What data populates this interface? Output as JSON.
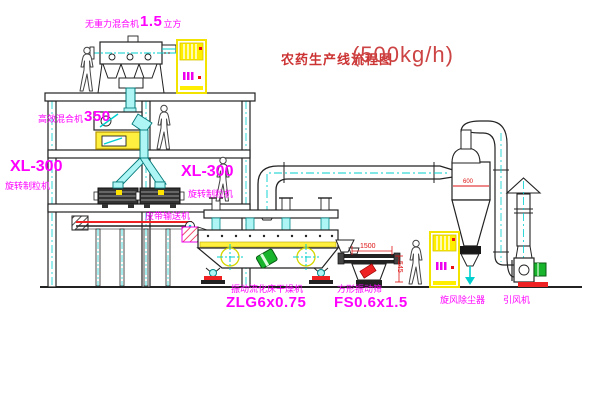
{
  "title": {
    "name": "农药生产线流程图",
    "capacity": "(500kg/h)"
  },
  "equipment": {
    "gravity_mixer": {
      "name": "无重力混合机",
      "size": "1.5",
      "unit": "立方"
    },
    "mixer_350": {
      "name": "高效混合机",
      "model": "350"
    },
    "granulator_left": {
      "model": "XL-300",
      "name": "旋转制粒机"
    },
    "granulator_right": {
      "model": "XL-300",
      "name": "旋转制粒机"
    },
    "belt_conveyor": {
      "name": "皮带输送机"
    },
    "fluid_bed_dryer": {
      "name": "振动流化床干燥机",
      "model": "ZLG6x0.75"
    },
    "vibrating_screen": {
      "name": "方形振动筛",
      "model": "FS0.6x1.5"
    },
    "cyclone": {
      "name": "旋风除尘器"
    },
    "fan": {
      "name": "引风机"
    }
  },
  "dimensions": {
    "screen_length": "1500",
    "screen_height": "545",
    "cyclone_inlet": "600"
  },
  "colors": {
    "label_magenta": "#ff00ff",
    "title_red": "#cc3333",
    "line_dark": "#222222",
    "centerline_cyan": "#00cfcf",
    "cabinet_yellow": "#ffee00",
    "accent_red": "#ee2222",
    "motor_green": "#18b42c"
  }
}
